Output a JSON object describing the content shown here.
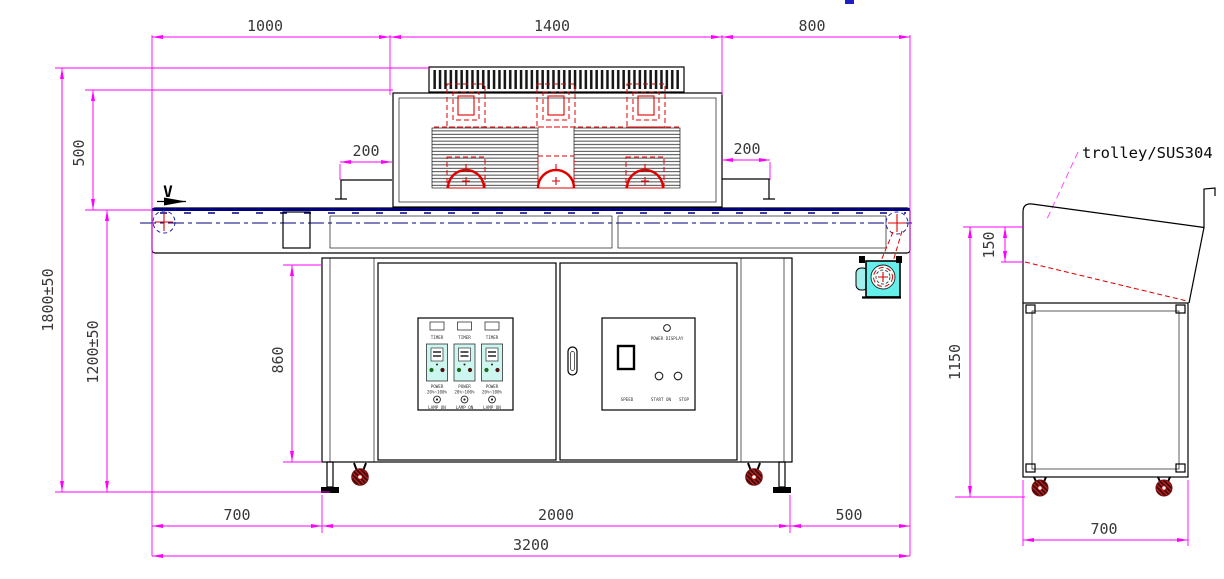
{
  "colors": {
    "dimension_lines": "#FF00FF",
    "outline": "#000000",
    "belt_centerline": "#00007F",
    "lamp_red": "#E00000",
    "fan_cyan": "#66EFEA",
    "panel_unit_cyan": "#CDF6F0",
    "dim_text": "#383838"
  },
  "front_view": {
    "direction_label": "V",
    "dimensions": {
      "top_left": "1000",
      "top_center": "1400",
      "top_right": "800",
      "height_total": "1800±50",
      "lamp_to_belt": "500",
      "height_belt": "1200±50",
      "cabinet_height": "860",
      "guard_left": "200",
      "guard_right": "200",
      "bottom_left": "700",
      "bottom_center": "2000",
      "bottom_right": "500",
      "bottom_total": "3200"
    },
    "left_panel": {
      "channels": [
        {
          "timer": "TIMER",
          "power": "POWER",
          "range": "20%~100%",
          "lamp": "LAMP ON"
        },
        {
          "timer": "TIMER",
          "power": "POWER",
          "range": "20%~100%",
          "lamp": "LAMP ON"
        },
        {
          "timer": "TIMER",
          "power": "POWER",
          "range": "20%~100%",
          "lamp": "LAMP ON"
        }
      ]
    },
    "right_panel": {
      "power_display": "POWER DISPLAY",
      "speed": "SPEED",
      "start": "START ON",
      "stop": "STOP"
    }
  },
  "trolley_view": {
    "label": "trolley/SUS304",
    "dimensions": {
      "lip_height": "150",
      "height": "1150",
      "width": "700"
    }
  }
}
